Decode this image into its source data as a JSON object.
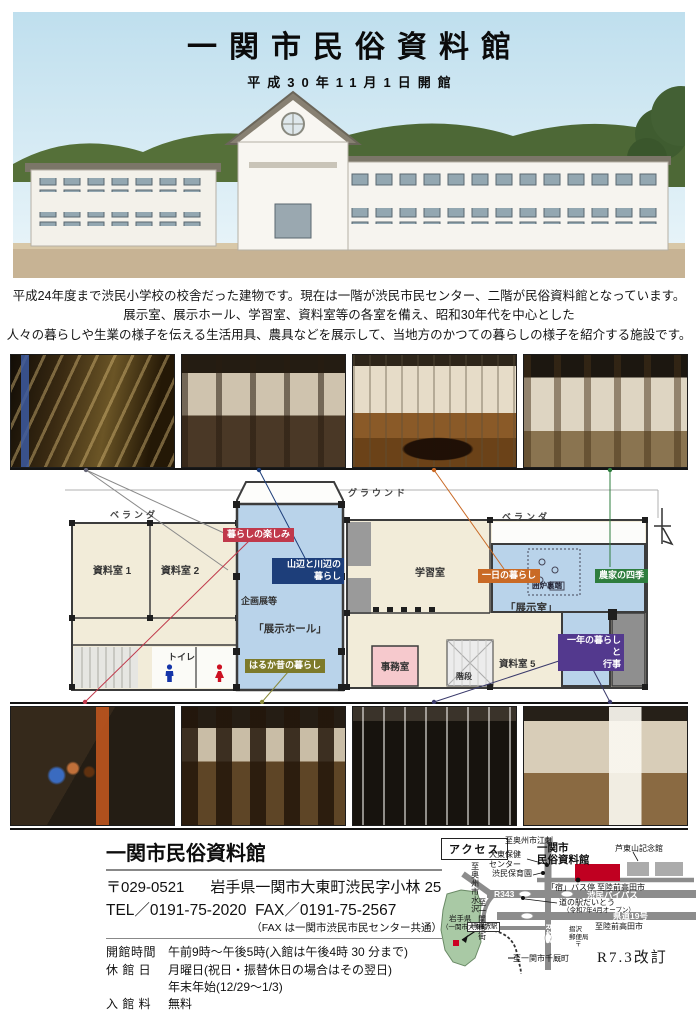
{
  "header": {
    "title": "一関市民俗資料館",
    "subtitle": "平成30年11月1日開館"
  },
  "intro": {
    "lines": [
      "平成24年度まで渋民小学校の校舎だった建物です。現在は一階が渋民市民センター、二階が民俗資料館となっています。",
      "展示室、展示ホール、学習室、資料室等の各室を備え、昭和30年代を中心とした",
      "人々の暮らしや生業の様子を伝える生活用具、農具などを展示して、当地方のかつての暮らしの様子を紹介する施設です。"
    ]
  },
  "photos": {
    "hero": "旧渋民小学校校舎の外観写真",
    "top": [
      "壁面の農具・民具展示",
      "機織り機と民具の展示",
      "囲炉裏のある座敷の再現",
      "わら細工と解説パネルの展示"
    ],
    "bottom": [
      "晴れ着・人形の展示",
      "陶器・焼物の展示",
      "編み細工の展示",
      "木製民具の展示"
    ]
  },
  "plan": {
    "site": {
      "veranda_left": "ベランダ",
      "ground": "グラウンド",
      "veranda_right": "ベランダ"
    },
    "rooms": {
      "shiryo1": "資料室 1",
      "shiryo2": "資料室 2",
      "kikakuten": "企画展等",
      "tenji_hall": "「展示ホール」",
      "toilet": "トイレ",
      "gakushu": "学習室",
      "irori": "囲炉裏端",
      "tenji_room": "「展示室」",
      "jimu": "事務室",
      "kaidan": "階段",
      "shiryo5": "資料室 5"
    },
    "tags": [
      {
        "label": "暮らしの楽しみ",
        "color": "#c0394b"
      },
      {
        "label": "山辺と川辺の",
        "label2": "暮らし",
        "color": "#1d3e7a"
      },
      {
        "label": "はるか昔の暮らし",
        "color": "#7d7a2a"
      },
      {
        "label": "一日の暮らし",
        "color": "#c96a26"
      },
      {
        "label": "農家の四季",
        "color": "#2e7d3e"
      },
      {
        "label": "一年の暮らしと",
        "label2": "行事",
        "color": "#53398e"
      }
    ]
  },
  "footer": {
    "name": "一関市民俗資料館",
    "postal": "〒029-0521",
    "address": "岩手県一関市大東町渋民字小林 25",
    "tel": "TEL／0191-75-2020  FAX／0191-75-2567",
    "fax_note": "（FAX は一関市渋民市民センター共通）",
    "rows": [
      {
        "label": "開館時間",
        "value": "午前9時～午後5時(入館は午後4時 30 分まで)"
      },
      {
        "label": "休 館 日",
        "value": "月曜日(祝日・振替休日の場合はその翌日)",
        "value2": "年末年始(12/29～1/3)"
      },
      {
        "label": "入 館 料",
        "value": "無料"
      }
    ],
    "revision": "R7.3改訂"
  },
  "map": {
    "access_label": "アクセス",
    "to_esashi": "至奥州市江刺",
    "museum_line1": "一関市",
    "museum_line2": "民俗資料館",
    "ashitozan": "芦東山記念館",
    "hoken_line1": "大東保健",
    "hoken_line2": "センター",
    "hoikuen": "渋民保育園",
    "to_mizusawa": "至奥州市水沢",
    "to_ichinoseki": "至一関市街",
    "r343": "R343",
    "bus_stop": "「宿」バス停",
    "to_rikuzen1": "至陸前高田市",
    "bypass": "渋民バイパス",
    "michinoeki": "道の駅だいとう",
    "michinoeki_note": "（令和7年4月オープン）",
    "kendo19": "県道19号",
    "to_rikuzen2": "至陸前高田市",
    "r456": "R456",
    "post_line1": "摺沢",
    "post_line2": "郵便局",
    "post_mark": "〒",
    "station": "JR摺沢駅",
    "to_senmaya": "至一関市千厩町",
    "iwate": "岩手県",
    "iwate_note": "（一関市大東町）"
  },
  "colors": {
    "museum_red": "#c00021",
    "pref_green": "#a9c9a5",
    "plan_blue": "#b9d3ea",
    "office_pink": "#f6c9cd"
  }
}
